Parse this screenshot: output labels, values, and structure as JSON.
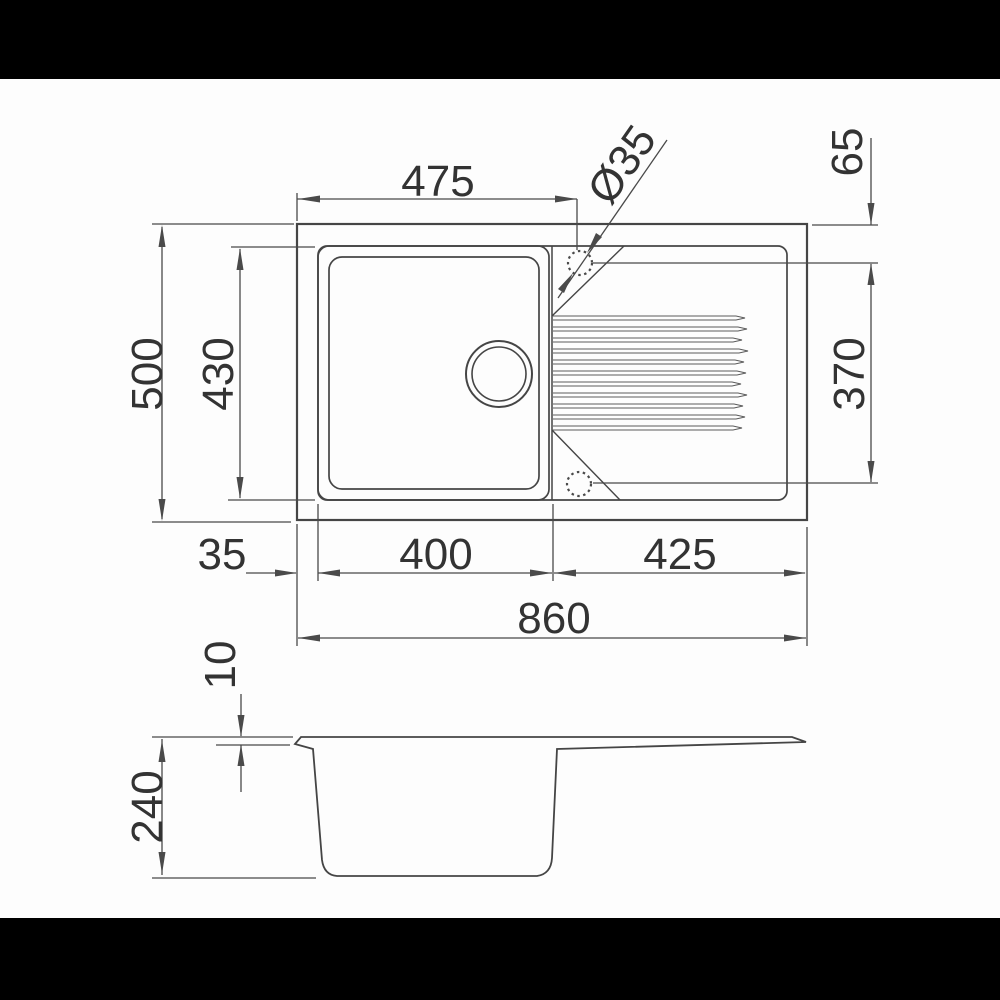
{
  "colors": {
    "background": "#fdfdfd",
    "letterbox_band": "#000000",
    "line": "#4a4a4a",
    "text": "#333333"
  },
  "top_view": {
    "dim_left_edge_to_hole": "475",
    "dim_tap_hole_diameter": "Ø35",
    "dim_hole_to_top_edge": "65",
    "dim_overall_depth": "500",
    "dim_bowl_depth": "430",
    "dim_hole_to_hole": "370",
    "dim_left_rim": "35",
    "dim_bowl_width": "400",
    "dim_drainer_width": "425",
    "dim_overall_width": "860"
  },
  "section_view": {
    "dim_top_thickness": "10",
    "dim_bowl_height": "240"
  }
}
